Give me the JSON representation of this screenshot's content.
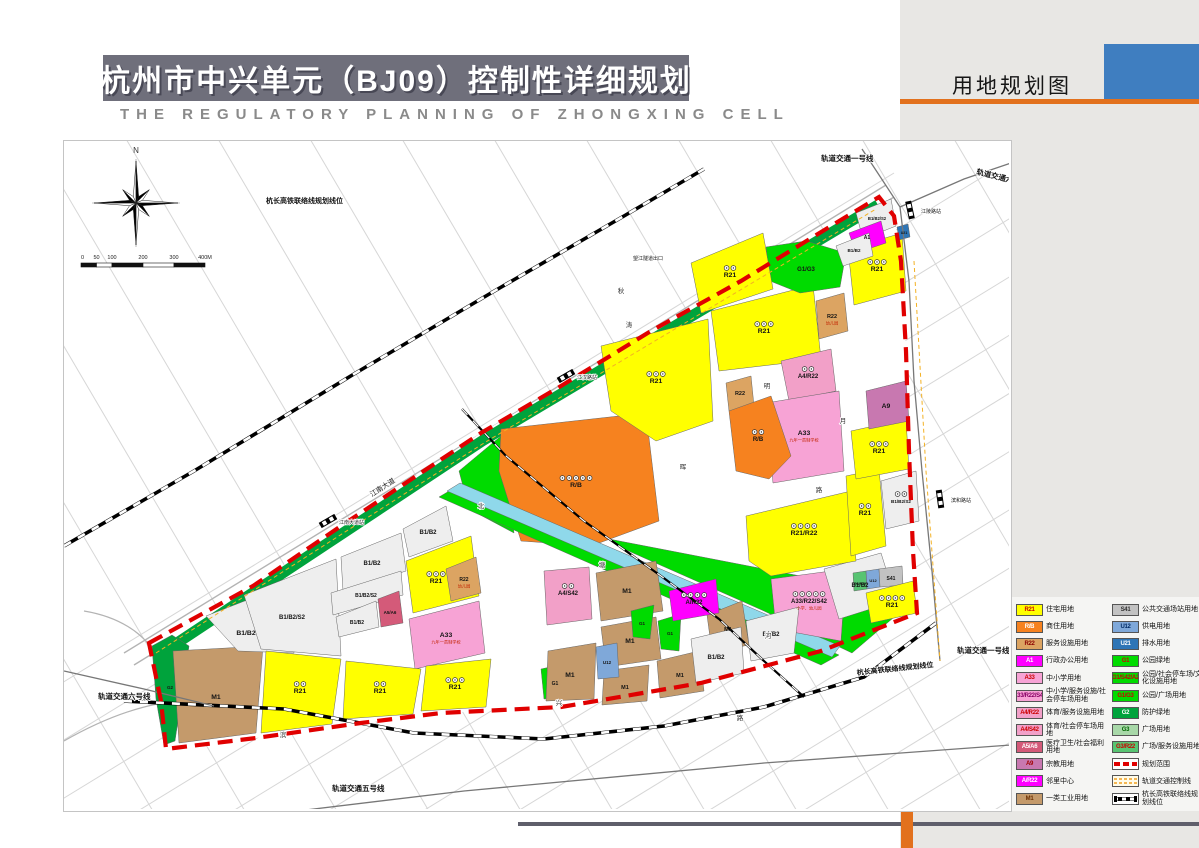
{
  "header": {
    "title": "杭州市中兴单元（BJ09）控制性详细规划",
    "subtitle": "THE REGULATORY PLANNING OF ZHONGXING CELL",
    "sheet_label": "用地规划图"
  },
  "colors": {
    "R21": "#FFFF00",
    "RB": "#F6821F",
    "R22": "#DCA462",
    "A1": "#FF00FF",
    "A33": "#F7A3D5",
    "A4R22": "#F2A0C8",
    "A4S42": "#F2A0C8",
    "A5A6": "#D45A79",
    "A9": "#C878B0",
    "AR22": "#FF00FF",
    "M1": "#C49A6B",
    "S41": "#C2C2C2",
    "U12": "#7FA8D9",
    "U21": "#2E75B6",
    "G1": "#00DB00",
    "G2": "#00A33C",
    "G3": "#A8D8A8",
    "G3R22": "#58C472",
    "RIV": "#8FD8EA",
    "boundary": "#E00000",
    "accent_orange": "#E2711D",
    "accent_blue": "#3F7EC0",
    "banner": "#6F6F7B",
    "panel": "#E8E7E4"
  },
  "legend": {
    "left": [
      {
        "code": "R21",
        "sw": "R21",
        "tc": "#cc0000",
        "label": "住宅用地"
      },
      {
        "code": "R/B",
        "sw": "RB",
        "tc": "#ffffff",
        "label": "商住用地"
      },
      {
        "code": "R22",
        "sw": "R22",
        "tc": "#8b0000",
        "label": "服务设施用地"
      },
      {
        "code": "A1",
        "sw": "A1",
        "tc": "#ffffff",
        "label": "行政办公用地"
      },
      {
        "code": "A33",
        "sw": "A33",
        "tc": "#cc0000",
        "label": "中小学用地"
      },
      {
        "code": "A33/R22/S42",
        "sw": "A33",
        "tc": "#880066",
        "label": "中小学/服务设施/社会停车场用地"
      },
      {
        "code": "A4/R22",
        "sw": "A4R22",
        "tc": "#cc0000",
        "label": "体育/服务设施用地"
      },
      {
        "code": "A4/S42",
        "sw": "A4S42",
        "tc": "#cc0000",
        "label": "体育/社会停车场用地"
      },
      {
        "code": "A5/A6",
        "sw": "A5A6",
        "tc": "#ffffff",
        "label": "医疗卫生/社会福利用地"
      },
      {
        "code": "A9",
        "sw": "A9",
        "tc": "#a00000",
        "label": "宗教用地"
      },
      {
        "code": "A/R22",
        "sw": "AR22",
        "tc": "#ffffff",
        "label": "邻里中心"
      },
      {
        "code": "M1",
        "sw": "M1",
        "tc": "#6b2f00",
        "label": "一类工业用地"
      }
    ],
    "right": [
      {
        "code": "S41",
        "sw": "S41",
        "tc": "#333333",
        "label": "公共交通场站用地"
      },
      {
        "code": "U12",
        "sw": "U12",
        "tc": "#002b66",
        "label": "供电用地"
      },
      {
        "code": "U21",
        "sw": "U21",
        "tc": "#ffffff",
        "label": "排水用地"
      },
      {
        "code": "G1",
        "sw": "G1",
        "tc": "#cc0000",
        "label": "公园绿地"
      },
      {
        "code": "G1/S42/A2",
        "sw": "G1",
        "tc": "#cc0000",
        "label": "公园/社会停车场/文化设施用地"
      },
      {
        "code": "G1/G3",
        "sw": "G1",
        "tc": "#cc0000",
        "label": "公园/广场用地"
      },
      {
        "code": "G2",
        "sw": "G2",
        "tc": "#ffffff",
        "label": "防护绿地"
      },
      {
        "code": "G3",
        "sw": "G3",
        "tc": "#006600",
        "label": "广场用地"
      },
      {
        "code": "G3/R22",
        "sw": "G3R22",
        "tc": "#cc0000",
        "label": "广场/服务设施用地"
      },
      {
        "type": "boundary",
        "label": "规划范围"
      },
      {
        "type": "railctl",
        "label": "轨道交通控制线"
      },
      {
        "type": "hsr",
        "label": "杭长高铁联络线规划线位"
      }
    ]
  },
  "map": {
    "compass_label": "N",
    "scalebar": {
      "labels": [
        "0",
        "50",
        "100",
        "200",
        "300",
        "400M"
      ]
    },
    "boundary_path": "85,502 189,445 277,385 417,292 497,245 587,190 677,140 767,85 815,56 830,75 837,120 842,210 845,310 849,410 853,472 757,510 637,542 497,566 377,572 297,582 192,597 102,608 97,560",
    "green_band": "104,508 418,300 814,64",
    "zones": [
      {
        "c": "G2",
        "p": "88,505 108,494 125,505 111,600 100,604 92,558",
        "l": "G2",
        "x": 106,
        "y": 548,
        "ls": 4.5
      },
      {
        "c": "M1",
        "p": "109,510 199,505 192,592 115,602",
        "l": "M1",
        "x": 152,
        "y": 558
      },
      {
        "c": "B1B2",
        "p": "142,475 227,442 230,512 174,510",
        "l": "B1/B2",
        "x": 182,
        "y": 494
      },
      {
        "c": "B1B2",
        "p": "180,454 272,418 277,515 197,508",
        "l": "B1/B2/S2",
        "x": 228,
        "y": 478,
        "ls": 6
      },
      {
        "c": "B1B2",
        "p": "277,416 337,392 342,430 279,450",
        "l": "B1/B2",
        "x": 308,
        "y": 424,
        "ls": 6
      },
      {
        "c": "B1B2",
        "p": "267,452 337,430 339,454 269,474",
        "l": "B1/B2/S2",
        "x": 302,
        "y": 456,
        "ls": 5
      },
      {
        "c": "B1B2",
        "p": "272,476 312,460 315,486 275,496",
        "l": "B1/B2",
        "x": 293,
        "y": 483,
        "ls": 5
      },
      {
        "c": "A5A6",
        "p": "314,458 335,450 339,482 317,486",
        "l": "A5/A6",
        "x": 326,
        "y": 473,
        "ls": 4.5
      },
      {
        "c": "B1B2",
        "p": "339,388 382,365 389,400 345,416",
        "l": "B1/B2",
        "x": 364,
        "y": 393,
        "ls": 6
      },
      {
        "c": "R21",
        "p": "342,420 407,395 415,455 349,472",
        "l": "R21",
        "x": 372,
        "y": 442,
        "i": 3
      },
      {
        "c": "R22",
        "p": "382,428 412,416 417,452 387,460",
        "l": "R22",
        "x": 400,
        "y": 440,
        "ls": 5,
        "s": "幼儿园"
      },
      {
        "c": "A33",
        "p": "345,478 415,460 421,512 351,528",
        "l": "A33",
        "x": 382,
        "y": 496,
        "s": "九年一贯制学校"
      },
      {
        "c": "R21",
        "p": "202,510 277,518 268,583 197,592",
        "l": "R21",
        "x": 236,
        "y": 552,
        "i": 2
      },
      {
        "c": "R21",
        "p": "282,520 357,528 349,573 279,578",
        "l": "R21",
        "x": 316,
        "y": 552,
        "i": 2
      },
      {
        "c": "R21",
        "p": "362,525 427,518 422,566 357,570",
        "l": "R21",
        "x": 391,
        "y": 548,
        "i": 3
      },
      {
        "c": "G1",
        "p": "477,528 505,522 502,556 480,558",
        "l": "G1",
        "x": 491,
        "y": 544,
        "ls": 5
      },
      {
        "c": "G1",
        "p": "395,330 437,295 450,392 405,368"
      },
      {
        "c": "RB",
        "p": "437,288 582,272 595,380 527,405 457,400 435,330",
        "l": "R/B",
        "x": 512,
        "y": 346,
        "i": 5
      },
      {
        "c": "G1",
        "p": "545,398 840,455 842,466 788,512 700,470 560,408"
      },
      {
        "c": "G1",
        "p": "375,356 392,346 775,514 757,524"
      },
      {
        "c": "RIV",
        "p": "383,350 396,342 776,505 768,516"
      },
      {
        "c": "A4S42",
        "p": "480,430 525,426 528,478 483,484",
        "l": "A4/S42",
        "x": 504,
        "y": 454,
        "ls": 6,
        "i": 2
      },
      {
        "c": "M1",
        "p": "532,432 592,420 599,470 537,480",
        "l": "M1",
        "x": 563,
        "y": 452
      },
      {
        "c": "M1",
        "p": "537,486 592,476 597,518 542,526",
        "l": "M1",
        "x": 566,
        "y": 502
      },
      {
        "c": "M1",
        "p": "484,510 532,502 530,558 482,560",
        "l": "M1",
        "x": 506,
        "y": 536
      },
      {
        "c": "M1",
        "p": "540,530 585,524 583,560 538,564",
        "l": "M1",
        "x": 561,
        "y": 548,
        "ls": 5.5
      },
      {
        "c": "M1",
        "p": "593,520 635,510 640,550 596,557",
        "l": "M1",
        "x": 616,
        "y": 536,
        "ls": 5.5
      },
      {
        "c": "M1",
        "p": "643,474 678,460 685,504 648,511",
        "l": "M1",
        "x": 664,
        "y": 490,
        "ls": 5.5
      },
      {
        "c": "U12",
        "p": "532,506 553,502 555,536 534,538",
        "l": "U12",
        "x": 543,
        "y": 523,
        "ls": 4.5
      },
      {
        "c": "G1",
        "p": "567,470 590,464 586,498 569,496",
        "l": "G1",
        "x": 578,
        "y": 484,
        "ls": 4.5
      },
      {
        "c": "G1",
        "p": "594,480 617,473 615,510 597,508",
        "l": "G1",
        "x": 606,
        "y": 494,
        "ls": 4.5
      },
      {
        "c": "AR22",
        "p": "605,450 652,438 655,472 609,480",
        "l": "A/R22",
        "x": 630,
        "y": 463,
        "ls": 6,
        "i": 4
      },
      {
        "c": "A33",
        "p": "707,438 782,428 777,500 712,488",
        "l": "A33/R22/S42",
        "x": 745,
        "y": 462,
        "ls": 6,
        "i": 5,
        "s": "小学、幼儿园"
      },
      {
        "c": "B1B2",
        "p": "627,498 677,486 680,532 632,542",
        "l": "B1/B2",
        "x": 652,
        "y": 518,
        "ls": 6
      },
      {
        "c": "B1B2",
        "p": "682,480 735,466 730,512 687,520",
        "l": "B1/B2",
        "x": 707,
        "y": 495,
        "ls": 6
      },
      {
        "c": "B1B2",
        "p": "760,428 817,412 832,460 775,478",
        "l": "B1/B2",
        "x": 796,
        "y": 446,
        "ls": 6
      },
      {
        "c": "R21",
        "p": "682,375 787,350 792,420 707,435 685,420",
        "l": "R21/R22",
        "x": 740,
        "y": 394,
        "i": 4
      },
      {
        "c": "G3R22",
        "p": "789,432 802,430 803,448 790,450",
        "l": "G3/R22",
        "x": 796,
        "y": 444,
        "ls": 3.4
      },
      {
        "c": "U12",
        "p": "802,430 815,428 816,446 803,448",
        "l": "U12",
        "x": 809,
        "y": 441,
        "ls": 4
      },
      {
        "c": "S41",
        "p": "815,428 838,425 839,444 816,446",
        "l": "S41",
        "x": 827,
        "y": 439,
        "ls": 5
      },
      {
        "c": "R21",
        "p": "802,452 849,440 853,472 807,482",
        "l": "R21",
        "x": 828,
        "y": 466,
        "i": 4
      },
      {
        "c": "B1B2",
        "p": "817,340 852,330 855,380 822,388",
        "l": "B1/B2/S2",
        "x": 837,
        "y": 362,
        "ls": 4.6,
        "i": 2
      },
      {
        "c": "R21",
        "p": "782,335 815,328 822,405 787,415",
        "l": "R21",
        "x": 801,
        "y": 374,
        "i": 2
      },
      {
        "c": "R21",
        "p": "787,290 842,278 845,328 792,338",
        "l": "R21",
        "x": 815,
        "y": 312,
        "i": 3
      },
      {
        "c": "R21",
        "p": "647,170 749,144 757,218 655,230",
        "l": "R21",
        "x": 700,
        "y": 192,
        "i": 3
      },
      {
        "c": "R22",
        "p": "752,160 780,152 784,190 755,198",
        "l": "R22",
        "x": 768,
        "y": 177,
        "ls": 5.5,
        "s": "幼儿园"
      },
      {
        "c": "R21",
        "p": "784,108 838,92 842,150 790,164",
        "l": "R21",
        "x": 813,
        "y": 130,
        "i": 3
      },
      {
        "c": "A4R22",
        "p": "717,220 767,208 772,250 725,260",
        "l": "A4/R22",
        "x": 744,
        "y": 237,
        "ls": 6,
        "i": 2
      },
      {
        "c": "A33",
        "p": "702,262 775,250 780,330 709,342",
        "l": "A33",
        "x": 740,
        "y": 294,
        "s": "九年一贯制学校"
      },
      {
        "c": "A9",
        "p": "802,250 842,240 845,280 805,288",
        "l": "A9",
        "x": 822,
        "y": 267
      },
      {
        "c": "R22",
        "p": "662,242 687,235 690,265 665,270",
        "l": "R22",
        "x": 676,
        "y": 254,
        "ls": 5.5
      },
      {
        "c": "RB",
        "p": "665,270 707,255 727,315 705,338 672,330",
        "l": "R/B",
        "x": 694,
        "y": 300,
        "ls": 6,
        "i": 2
      },
      {
        "c": "R21",
        "p": "537,205 644,178 649,280 592,300 547,270",
        "l": "R21",
        "x": 592,
        "y": 242,
        "i": 3
      },
      {
        "c": "G1",
        "p": "702,106 742,100 782,112 776,146 736,152 706,140",
        "l": "G1/G3",
        "x": 742,
        "y": 130,
        "ls": 6
      },
      {
        "c": "R21",
        "p": "627,122 699,92 709,148 637,172",
        "l": "R21",
        "x": 666,
        "y": 136,
        "i": 2
      },
      {
        "c": "B1B2",
        "p": "792,72 827,58 832,85 799,98",
        "l": "B1/B2/S2",
        "x": 813,
        "y": 79,
        "ls": 4.2
      },
      {
        "c": "A1",
        "p": "785,92 817,80 822,102 792,112",
        "l": "A1",
        "x": 803,
        "y": 98,
        "ls": 5
      },
      {
        "c": "B1B2",
        "p": "772,105 805,92 809,115 779,125",
        "l": "B1/B2",
        "x": 790,
        "y": 111,
        "ls": 4.6
      },
      {
        "c": "U21",
        "p": "833,86 844,83 846,96 835,99",
        "l": "U21",
        "x": 840,
        "y": 93,
        "ls": 3.6
      }
    ],
    "rail_lines": [
      {
        "pts": "798,8 836,66 845,140 850,240 858,330 868,430 876,520"
      },
      {
        "pts": "836,66 900,38 947,22"
      },
      {
        "pts": "0,530 80,548 150,565"
      },
      {
        "pts": "150,680 400,650 700,622 947,604"
      }
    ],
    "hsr_lines": [
      {
        "pts": "0,405 130,330 290,233 427,152 560,75 640,28"
      },
      {
        "pts": "60,560 220,568 350,592 480,598 600,585 700,566 800,536 872,482"
      },
      {
        "pts": "398,268 442,315 520,380 597,435 655,478 700,520 740,556",
        "thin": true
      }
    ],
    "railctl_lines": [
      {
        "pts": "92,512 420,302 812,68"
      },
      {
        "pts": "850,120 862,330 876,520"
      }
    ],
    "stations": [
      {
        "n": "江南大道站",
        "x": 264,
        "y": 380,
        "r": -30
      },
      {
        "n": "江汉路站",
        "x": 502,
        "y": 235,
        "r": -30
      },
      {
        "n": "江陵路站",
        "x": 846,
        "y": 69,
        "r": 78
      },
      {
        "n": "滨和路站",
        "x": 876,
        "y": 358,
        "r": 82
      }
    ],
    "labels": [
      {
        "t": "轨道交通一号线",
        "x": 757,
        "y": 20,
        "r": 0,
        "fs": 7.5,
        "b": 1
      },
      {
        "t": "轨道交通六号线",
        "x": 912,
        "y": 33,
        "r": 14,
        "fs": 7.5,
        "b": 1
      },
      {
        "t": "杭长高铁联络线规划线位",
        "x": 202,
        "y": 62,
        "r": 0,
        "fs": 7,
        "b": 1
      },
      {
        "t": "轨道交通六号线",
        "x": 34,
        "y": 558,
        "r": 0,
        "fs": 7.5,
        "b": 1
      },
      {
        "t": "轨道交通五号线",
        "x": 268,
        "y": 650,
        "r": 0,
        "fs": 7.5,
        "b": 1
      },
      {
        "t": "轨道交通一号线",
        "x": 893,
        "y": 512,
        "r": 0,
        "fs": 7.5,
        "b": 1
      },
      {
        "t": "杭长高铁联络线规划线位",
        "x": 793,
        "y": 534,
        "r": -6,
        "fs": 7,
        "b": 1
      },
      {
        "t": "望江隧道出口",
        "x": 569,
        "y": 119,
        "r": 0,
        "fs": 5,
        "b": 0
      },
      {
        "t": "江南大道",
        "x": 308,
        "y": 356,
        "r": -33,
        "fs": 7,
        "b": 0
      }
    ],
    "chars": [
      {
        "t": "秋",
        "x": 557,
        "y": 152
      },
      {
        "t": "涛",
        "x": 565,
        "y": 186
      },
      {
        "t": "北",
        "x": 417,
        "y": 367
      },
      {
        "t": "明",
        "x": 703,
        "y": 247
      },
      {
        "t": "晖",
        "x": 619,
        "y": 328
      },
      {
        "t": "塘",
        "x": 538,
        "y": 426
      },
      {
        "t": "河",
        "x": 704,
        "y": 497
      },
      {
        "t": "滨",
        "x": 219,
        "y": 596
      },
      {
        "t": "兴",
        "x": 495,
        "y": 564
      },
      {
        "t": "路",
        "x": 676,
        "y": 579
      },
      {
        "t": "路",
        "x": 755,
        "y": 351
      },
      {
        "t": "月",
        "x": 779,
        "y": 282
      }
    ]
  }
}
